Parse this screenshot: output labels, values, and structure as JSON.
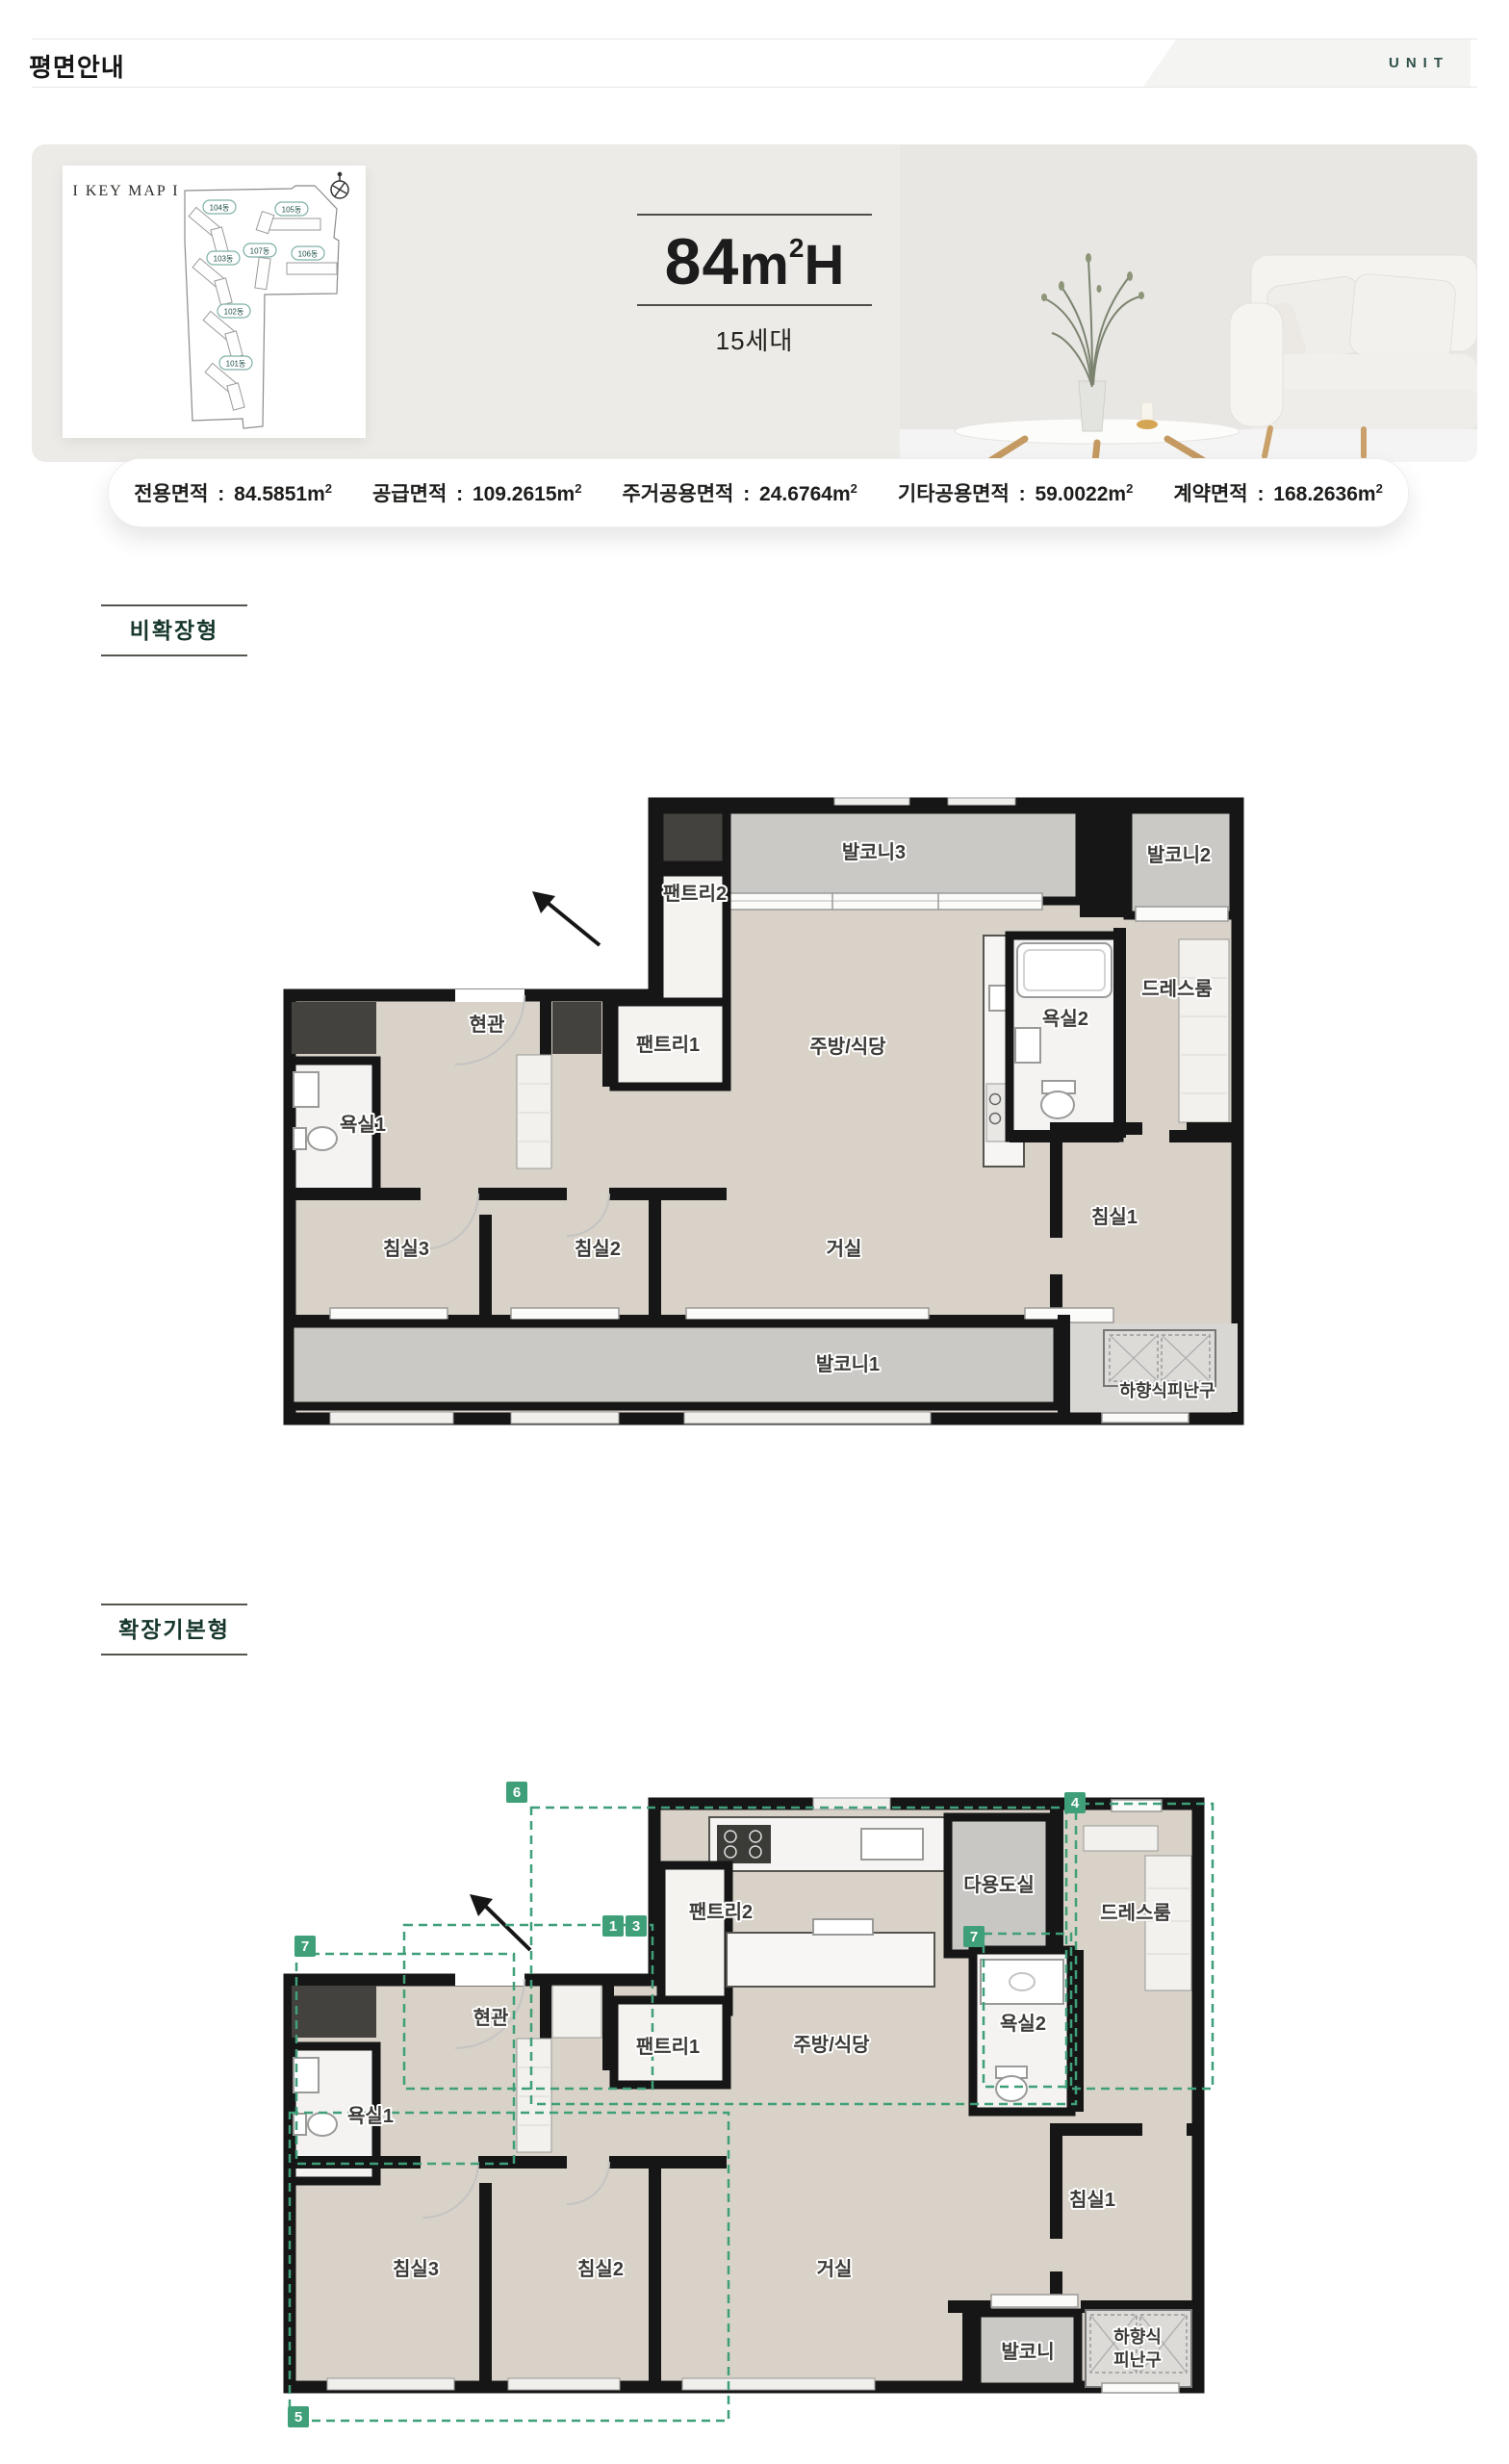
{
  "header": {
    "title": "평면안내",
    "corner_label": "UNIT"
  },
  "hero": {
    "keymap": {
      "title": "I KEY MAP I",
      "buildings": [
        "104동",
        "105동",
        "103동",
        "107동",
        "106동",
        "102동",
        "101동"
      ]
    },
    "unit_title": {
      "number": "84",
      "unit_base": "m",
      "unit_sup": "2",
      "suffix": "H"
    },
    "households": "15세대"
  },
  "area_info": {
    "separator": " : ",
    "unit_base": "m",
    "unit_sup": "2",
    "items": [
      {
        "label": "전용면적",
        "value": "84.5851"
      },
      {
        "label": "공급면적",
        "value": "109.2615"
      },
      {
        "label": "주거공용면적",
        "value": "24.6764"
      },
      {
        "label": "기타공용면적",
        "value": "59.0022"
      },
      {
        "label": "계약면적",
        "value": "168.2636"
      }
    ]
  },
  "sections": [
    {
      "label": "비확장형"
    },
    {
      "label": "확장기본형"
    }
  ],
  "plan_non_expanded": {
    "rooms": {
      "balcony3": "발코니3",
      "balcony2": "발코니2",
      "pantry2": "팬트리2",
      "entry": "현관",
      "pantry1": "팬트리1",
      "kitchen_dining": "주방/식당",
      "bath2": "욕실2",
      "dressroom": "드레스룸",
      "bath1": "욕실1",
      "bedroom3": "침실3",
      "bedroom2": "침실2",
      "living": "거실",
      "bedroom1": "침실1",
      "balcony1": "발코니1",
      "escape_hatch": "하향식피난구"
    }
  },
  "plan_expanded": {
    "rooms": {
      "pantry2": "팬트리2",
      "utility": "다용도실",
      "dressroom": "드레스룸",
      "entry": "현관",
      "pantry1": "팬트리1",
      "kitchen_dining": "주방/식당",
      "bath2": "욕실2",
      "bath1": "욕실1",
      "bedroom3": "침실3",
      "bedroom2": "침실2",
      "living": "거실",
      "bedroom1": "침실1",
      "balcony": "발코니",
      "escape_hatch_line1": "하향식",
      "escape_hatch_line2": "피난구"
    },
    "badges": {
      "b6": "6",
      "b4": "4",
      "b1": "1",
      "b3": "3",
      "b7a": "7",
      "b7b": "7",
      "b5": "5"
    }
  },
  "colors": {
    "accent": "#3f9f79",
    "section_text": "#17372c",
    "corner_text": "#2e5048"
  }
}
